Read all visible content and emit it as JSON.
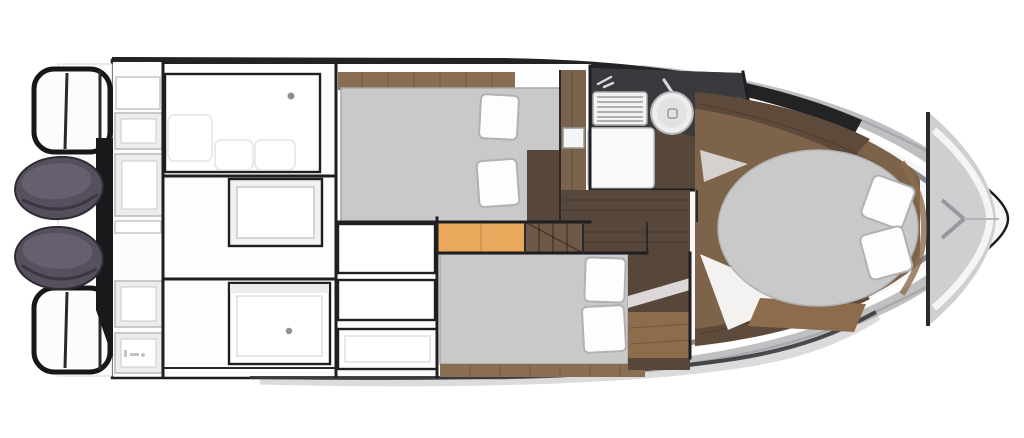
{
  "meta": {
    "title": "Motor boat interior floor plan (top-down view)",
    "description": "Deck plan: twin outboard engines and swim platform at stern, aft cockpit with bench seating and lockers, two mid-ship double cabins, head compartment with sink, toilet and shower grate, companionway steps, and forward owner cabin with island berth."
  },
  "colors": {
    "hull_outline": "#1c1c1e",
    "hull_fill": "#f7f7f8",
    "top_band": "#232326",
    "deck_gray": "#cfcfd1",
    "chrome_light": "#ffffff",
    "chrome_mid": "#b9b9bd",
    "chrome_dark": "#77777b",
    "berth_gray": "#c9c9ca",
    "berth_edge": "#a8a8aa",
    "wood_dark": "#57463a",
    "wood_mid": "#7a624c",
    "wood_floor": "#7c634a",
    "wood_bench": "#5d4a3a",
    "wood_strip": "#8a6e52",
    "wood_step": "#8d6c4e",
    "step_orange": "#e9a85c",
    "stairs_wood": "#6e5847",
    "counter_charcoal": "#3a393d",
    "engine_body": "#56505e",
    "engine_top": "#6a6472",
    "fixture_white": "#f2f2f3",
    "shower_pan": "#fafafa",
    "dot_gray": "#909092"
  },
  "inventory": {
    "engines": 2,
    "berths": [
      {
        "name": "mid-cabin-port-berth",
        "pillows": 2
      },
      {
        "name": "mid-cabin-starboard-berth",
        "pillows": 2
      },
      {
        "name": "bow-cabin-island-berth",
        "pillows": 2
      }
    ],
    "head_fixtures": [
      "shower-grate",
      "sink",
      "toilet",
      "shower-pan"
    ],
    "cockpit_features": [
      "sunpad-bench",
      "table-socket-dot",
      "storage-lockers"
    ],
    "stern_features": [
      "swim-platform",
      "grab-railings",
      "twin-outboard-engines"
    ],
    "other_features": [
      "companionway-steps",
      "wood-corridor",
      "foredeck-anchor-locker"
    ]
  }
}
